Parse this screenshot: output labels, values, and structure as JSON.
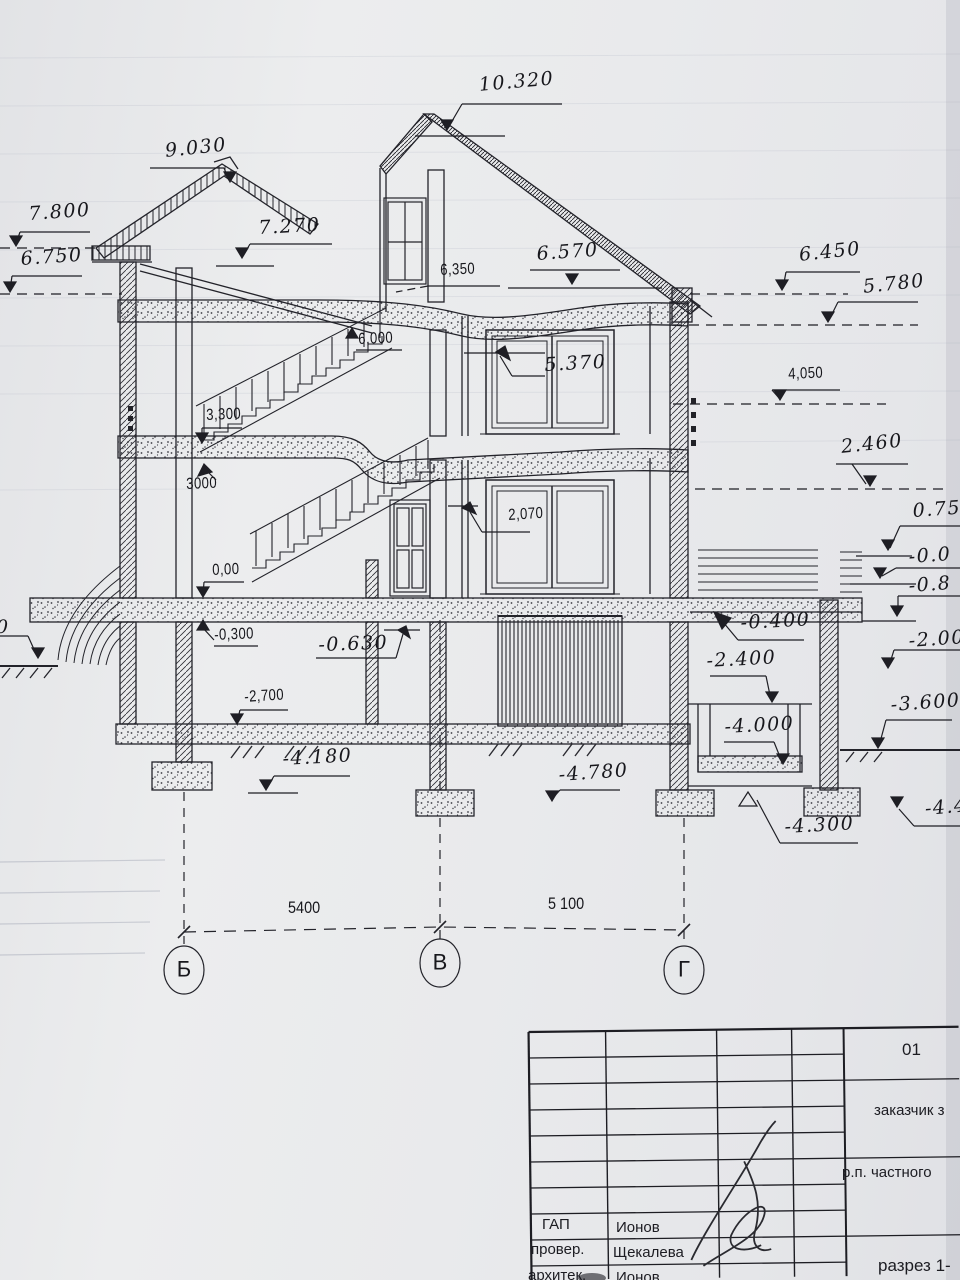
{
  "labels": {
    "m10_320": "10.320",
    "m9_030": "9.030",
    "m7_800": "7.800",
    "m7_270": "7.270",
    "m6_750": "6.750",
    "m6_350": "6,350",
    "m6_570": "6.570",
    "m6_450": "6.450",
    "m5_780": "5.780",
    "m6_000": "6,000",
    "m5_370": "5.370",
    "m4_050": "4,050",
    "m3_300": "3,300",
    "m2_460": "2.460",
    "m3000": "3000",
    "m2_070": "2,070",
    "m0_75": "0.75",
    "m0_00": "0,00",
    "m_0_0": "-0.0",
    "m_0_8": "-0.8",
    "m_0_300": "-0,300",
    "m_0_630": "-0.630",
    "m_0_400": "-0.400",
    "m_2_00": "-2.00",
    "m_2_400": "-2.400",
    "m_2_700": "-2,700",
    "m_3_600": "-3.600",
    "m_4_000": "-4.000",
    "m_4_180": "-4.180",
    "m_4_780": "-4.780",
    "m_4_300": "-4.300",
    "m_4_4": "-4.4",
    "m_left0": "0"
  },
  "axes": {
    "left": "Б",
    "center": "В",
    "right": "Г",
    "dim_left": "5400",
    "dim_right": "5 100"
  },
  "title_block": {
    "sheet_no": "01",
    "client": "заказчик з",
    "location": "р.п. частного",
    "title": "разрез 1-",
    "rows": [
      [
        "ГАП",
        "Ионов"
      ],
      [
        "провер.",
        "Щекалева"
      ],
      [
        "архитек.",
        "Ионов"
      ]
    ]
  }
}
